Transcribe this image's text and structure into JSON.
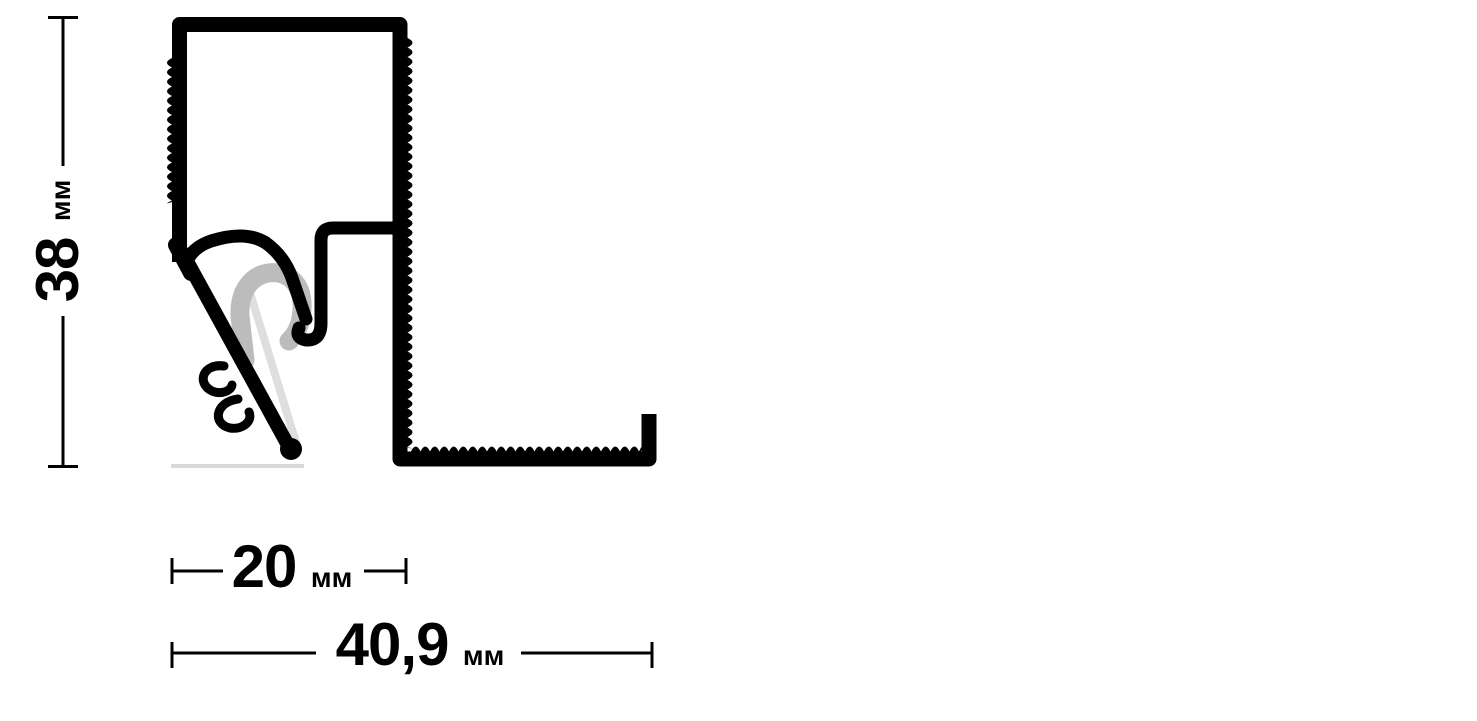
{
  "diagram": {
    "type": "technical-drawing",
    "subject": "aluminium-ceiling-profile-cross-section",
    "background": "#ffffff",
    "colors": {
      "outline": "#000000",
      "dimension": "#000000",
      "spring_clip": "#bcbcbc",
      "highlight": "#dedede",
      "baseline": "#d9d9d9"
    },
    "dimensions": {
      "height": {
        "value": "38",
        "unit": "мм"
      },
      "inner_width": {
        "value": "20",
        "unit": "мм"
      },
      "overall_width": {
        "value": "40,9",
        "unit": "мм"
      }
    }
  }
}
